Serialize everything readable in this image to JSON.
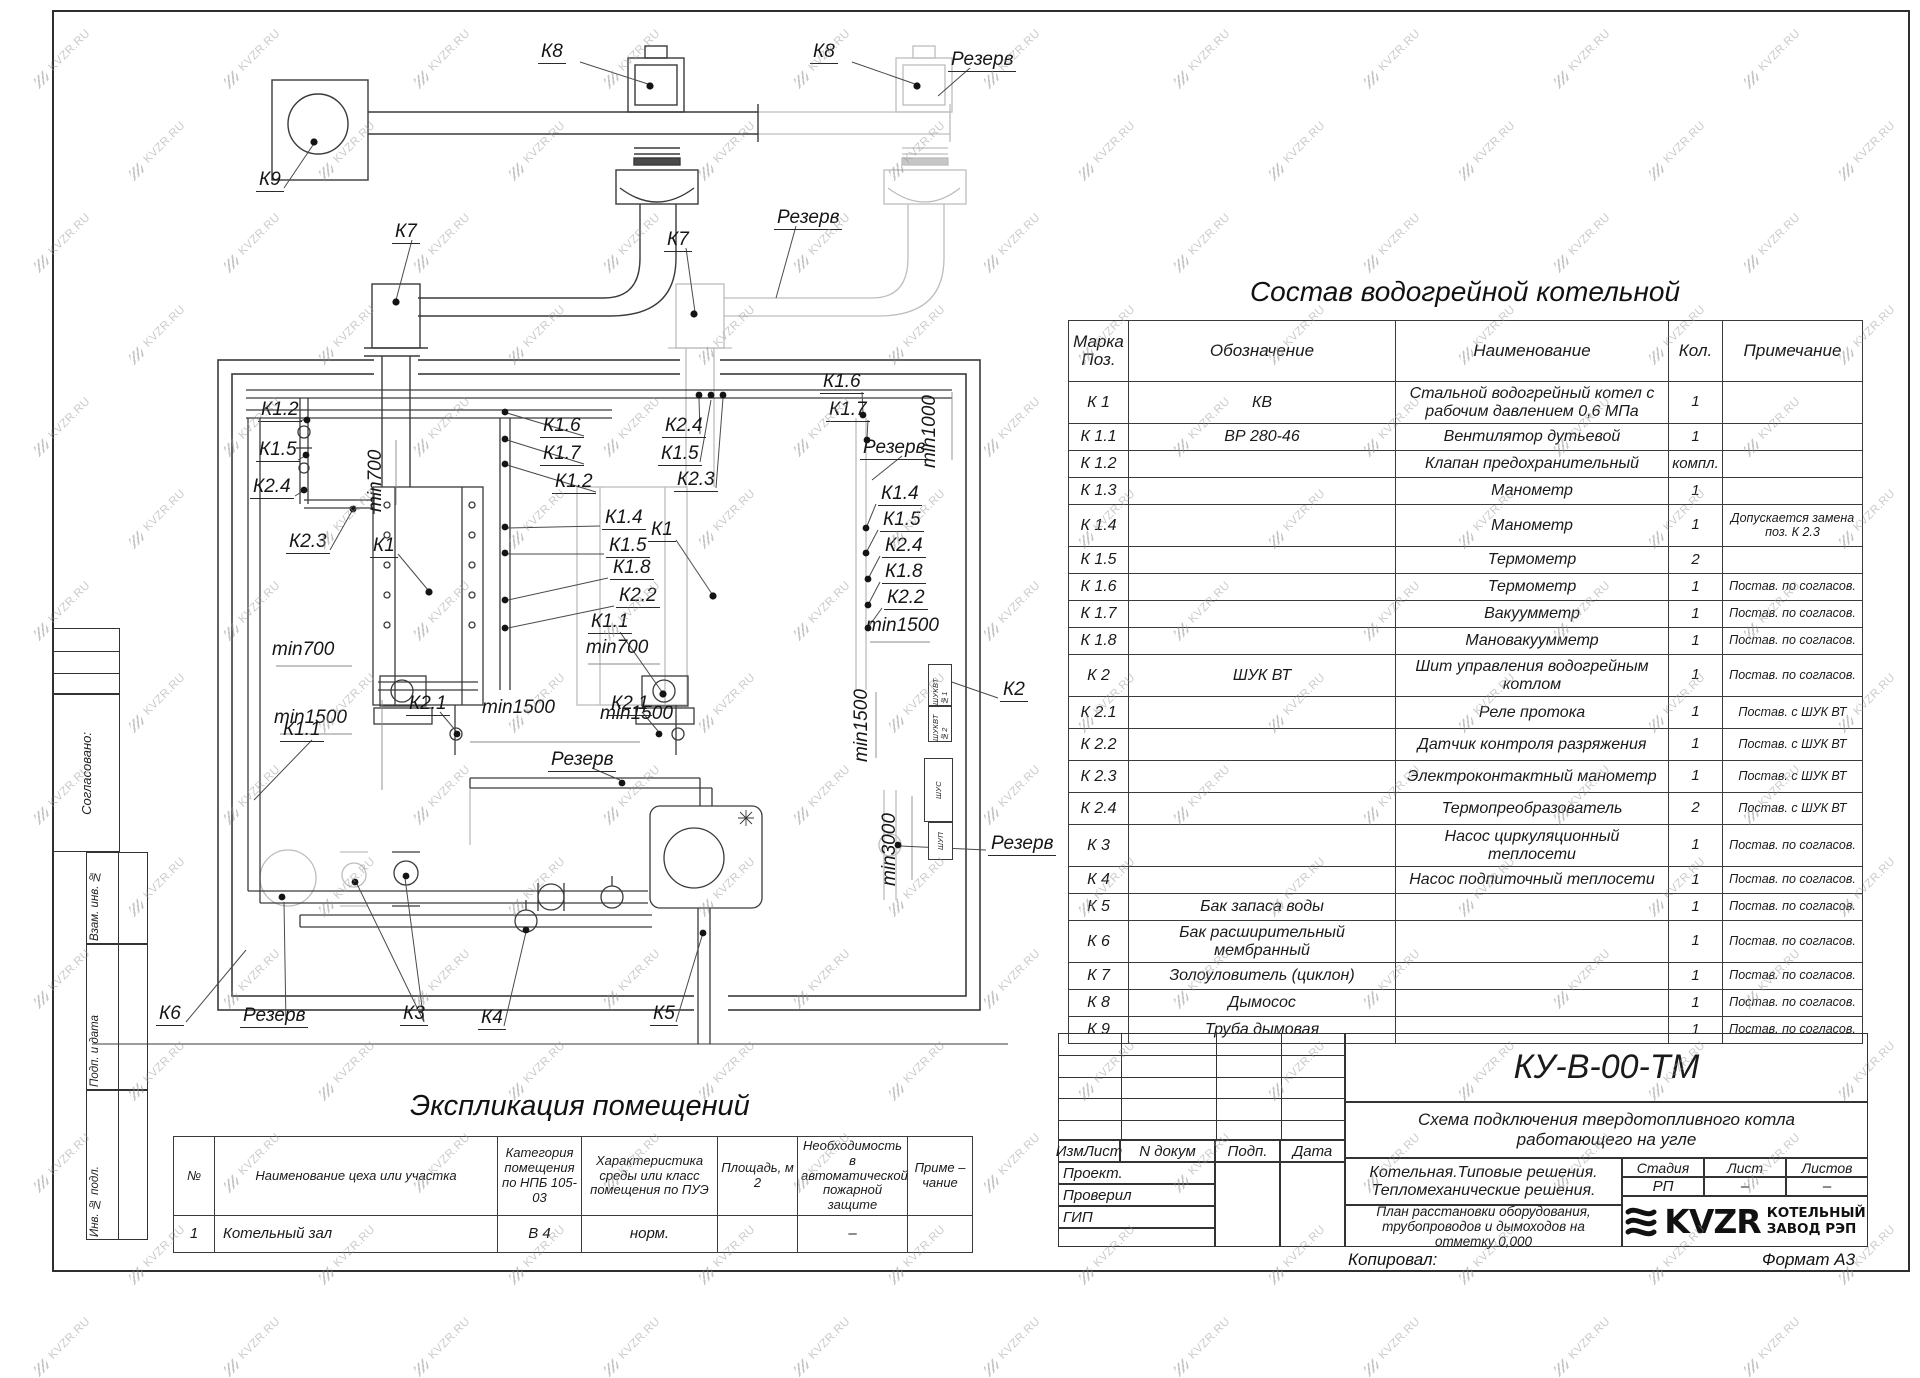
{
  "watermark": {
    "text": "KVZR.RU"
  },
  "sidebar": {
    "agreed": "Согласовано:",
    "boxes": [
      "Взам. инв. №",
      "Подп. и дата",
      "Инв. № подл."
    ]
  },
  "sostav": {
    "title": "Состав водогрейной котельной",
    "headers": {
      "mark": "Марка Поз.",
      "designation": "Обозначение",
      "name": "Наименование",
      "qty": "Кол.",
      "note": "Примечание"
    },
    "rows": [
      [
        "К 1",
        "КВ",
        "Стальной водогрейный котел с рабочим давлением 0,6  МПа",
        "1",
        ""
      ],
      [
        "К 1.1",
        "ВР 280-46",
        "Вентилятор дутьевой",
        "1",
        ""
      ],
      [
        "К 1.2",
        "",
        "Клапан предохранительный",
        "компл.",
        ""
      ],
      [
        "К 1.3",
        "",
        "Манометр",
        "1",
        ""
      ],
      [
        "К 1.4",
        "",
        "Манометр",
        "1",
        "Допускается замена поз. К 2.3"
      ],
      [
        "К 1.5",
        "",
        "Термометр",
        "2",
        ""
      ],
      [
        "К 1.6",
        "",
        "Термометр",
        "1",
        "Постав. по согласов."
      ],
      [
        "К 1.7",
        "",
        "Вакуумметр",
        "1",
        "Постав. по согласов."
      ],
      [
        "К 1.8",
        "",
        "Мановакуумметр",
        "1",
        "Постав. по согласов."
      ],
      [
        "К 2",
        "ШУК ВТ",
        "Шит управления водогрейным котлом",
        "1",
        "Постав. по согласов."
      ],
      [
        "К 2.1",
        "",
        "Реле протока",
        "1",
        "Постав. с ШУК ВТ"
      ],
      [
        "К 2.2",
        "",
        "Датчик контроля разряжения",
        "1",
        "Постав. с ШУК ВТ"
      ],
      [
        "К 2.3",
        "",
        "Электроконтактный манометр",
        "1",
        "Постав. с ШУК ВТ"
      ],
      [
        "К 2.4",
        "",
        "Термопреобразователь",
        "2",
        "Постав. с ШУК ВТ"
      ],
      [
        "К 3",
        "",
        "Насос циркуляционный теплосети",
        "1",
        "Постав. по согласов."
      ],
      [
        "К 4",
        "",
        "Насос подпиточный теплосети",
        "1",
        "Постав. по согласов."
      ],
      [
        "К 5",
        "Бак запаса воды",
        "",
        "1",
        "Постав. по согласов."
      ],
      [
        "К 6",
        "Бак расширительный мембранный",
        "",
        "1",
        "Постав. по согласов."
      ],
      [
        "К 7",
        "Золоуловитель  (циклон)",
        "",
        "1",
        "Постав. по согласов."
      ],
      [
        "К 8",
        "Дымосос",
        "",
        "1",
        "Постав. по согласов."
      ],
      [
        "К 9",
        "Труба дымовая",
        "",
        "1",
        "Постав. по согласов."
      ]
    ]
  },
  "explication": {
    "title": "Экспликация помещений",
    "headers": [
      "№",
      "Наименование цеха или участка",
      "Категория помещения по НПБ 105-03",
      "Характеристика среды или класс помещения по ПУЭ",
      "Площадь, м 2",
      "Необходимость в автоматической пожарной защите",
      "Приме – чание"
    ],
    "row": {
      "num": "1",
      "name": "Котельный зал",
      "category": "В 4",
      "env": "норм.",
      "area": "",
      "fire": "–",
      "note": ""
    }
  },
  "stamp": {
    "code": "КУ-В-00-ТМ",
    "doc_title": "Схема подключения твердотопливного котла работающего на угле",
    "solution1": "Котельная.Типовые решения.",
    "solution2": "Тепломеханические решения.",
    "plan_title": "План расстановки оборудования, трубопроводов и дымоходов на отметку  0,000",
    "cols": {
      "izm": "ИзмЛист",
      "ndoc": "N докум",
      "podp": "Подп.",
      "data": "Дата"
    },
    "roles": {
      "proekt": "Проект.",
      "proveril": "Проверил",
      "gip": "ГИП"
    },
    "stage_hdr": {
      "stage": "Стадия",
      "sheet": "Лист",
      "sheets": "Листов"
    },
    "stage_val": {
      "stage": "РП",
      "sheet": "–",
      "sheets": "–"
    },
    "copied": "Копировал:",
    "format": "Формат А3"
  },
  "logo": {
    "brand": "KVZR",
    "company_line1": "КОТЕЛЬНЫЙ",
    "company_line2": "ЗАВОД РЭП"
  },
  "diagram": {
    "labels": [
      {
        "t": "К8",
        "x": 538,
        "y": 42,
        "u": 1
      },
      {
        "t": "К8",
        "x": 810,
        "y": 42,
        "u": 1
      },
      {
        "t": "Резерв",
        "x": 948,
        "y": 50,
        "u": 1
      },
      {
        "t": "К9",
        "x": 256,
        "y": 170,
        "u": 1
      },
      {
        "t": "К7",
        "x": 392,
        "y": 222,
        "u": 1
      },
      {
        "t": "К7",
        "x": 664,
        "y": 230,
        "u": 1
      },
      {
        "t": "Резерв",
        "x": 774,
        "y": 208,
        "u": 1
      },
      {
        "t": "К1.2",
        "x": 258,
        "y": 400,
        "u": 1
      },
      {
        "t": "К1.5",
        "x": 256,
        "y": 440,
        "u": 1
      },
      {
        "t": "К2.4",
        "x": 250,
        "y": 477,
        "u": 1
      },
      {
        "t": "К2.3",
        "x": 286,
        "y": 532,
        "u": 1
      },
      {
        "t": "К1",
        "x": 370,
        "y": 536,
        "u": 1
      },
      {
        "t": "min700",
        "x": 366,
        "y": 512,
        "r": 1
      },
      {
        "t": "min700",
        "x": 272,
        "y": 640
      },
      {
        "t": "min1500",
        "x": 274,
        "y": 708
      },
      {
        "t": "К1.6",
        "x": 540,
        "y": 416,
        "u": 1
      },
      {
        "t": "К1.7",
        "x": 540,
        "y": 444,
        "u": 1
      },
      {
        "t": "К1.2",
        "x": 552,
        "y": 472,
        "u": 1
      },
      {
        "t": "К2.4",
        "x": 662,
        "y": 416,
        "u": 1
      },
      {
        "t": "К1.5",
        "x": 658,
        "y": 444,
        "u": 1
      },
      {
        "t": "К2.3",
        "x": 674,
        "y": 470,
        "u": 1
      },
      {
        "t": "К1.4",
        "x": 602,
        "y": 508,
        "u": 1
      },
      {
        "t": "К1.5",
        "x": 606,
        "y": 536,
        "u": 1
      },
      {
        "t": "К1",
        "x": 648,
        "y": 520,
        "u": 1
      },
      {
        "t": "К1.8",
        "x": 610,
        "y": 558,
        "u": 1
      },
      {
        "t": "К2.2",
        "x": 616,
        "y": 586,
        "u": 1
      },
      {
        "t": "К1.1",
        "x": 588,
        "y": 612,
        "u": 1
      },
      {
        "t": "min700",
        "x": 586,
        "y": 638
      },
      {
        "t": "min1500",
        "x": 600,
        "y": 704
      },
      {
        "t": "К1.6",
        "x": 820,
        "y": 372,
        "u": 1
      },
      {
        "t": "К1.7",
        "x": 826,
        "y": 400,
        "u": 1
      },
      {
        "t": "Резерв",
        "x": 860,
        "y": 438,
        "u": 1
      },
      {
        "t": "min1000",
        "x": 920,
        "y": 468,
        "r": 1
      },
      {
        "t": "К1.4",
        "x": 878,
        "y": 484,
        "u": 1
      },
      {
        "t": "К1.5",
        "x": 880,
        "y": 510,
        "u": 1
      },
      {
        "t": "К2.4",
        "x": 882,
        "y": 536,
        "u": 1
      },
      {
        "t": "К1.8",
        "x": 882,
        "y": 562,
        "u": 1
      },
      {
        "t": "К2.2",
        "x": 884,
        "y": 588,
        "u": 1
      },
      {
        "t": "min1500",
        "x": 866,
        "y": 616
      },
      {
        "t": "min1500",
        "x": 852,
        "y": 762,
        "r": 1
      },
      {
        "t": "min3000",
        "x": 880,
        "y": 886,
        "r": 1
      },
      {
        "t": "К2.1",
        "x": 406,
        "y": 694,
        "u": 1
      },
      {
        "t": "min1500",
        "x": 482,
        "y": 698
      },
      {
        "t": "К2.1",
        "x": 608,
        "y": 694,
        "u": 1
      },
      {
        "t": "Резерв",
        "x": 548,
        "y": 750,
        "u": 1
      },
      {
        "t": "К1.1",
        "x": 280,
        "y": 720,
        "u": 1
      },
      {
        "t": "К2",
        "x": 1000,
        "y": 680,
        "u": 1
      },
      {
        "t": "Резерв",
        "x": 988,
        "y": 834,
        "u": 1
      },
      {
        "t": "К6",
        "x": 156,
        "y": 1004,
        "u": 1
      },
      {
        "t": "Резерв",
        "x": 240,
        "y": 1006,
        "u": 1
      },
      {
        "t": "К3",
        "x": 400,
        "y": 1004,
        "u": 1
      },
      {
        "t": "К4",
        "x": 478,
        "y": 1008,
        "u": 1
      },
      {
        "t": "К5",
        "x": 650,
        "y": 1004,
        "u": 1
      }
    ],
    "cabinets": [
      {
        "t": "ШУКВТ №1",
        "x": 928,
        "y": 664,
        "w": 22,
        "h": 40
      },
      {
        "t": "ШУКВТ №2",
        "x": 928,
        "y": 706,
        "w": 22,
        "h": 34
      },
      {
        "t": "ШУС",
        "x": 924,
        "y": 758,
        "w": 27,
        "h": 62
      },
      {
        "t": "ШУП",
        "x": 928,
        "y": 822,
        "w": 23,
        "h": 36
      }
    ]
  }
}
